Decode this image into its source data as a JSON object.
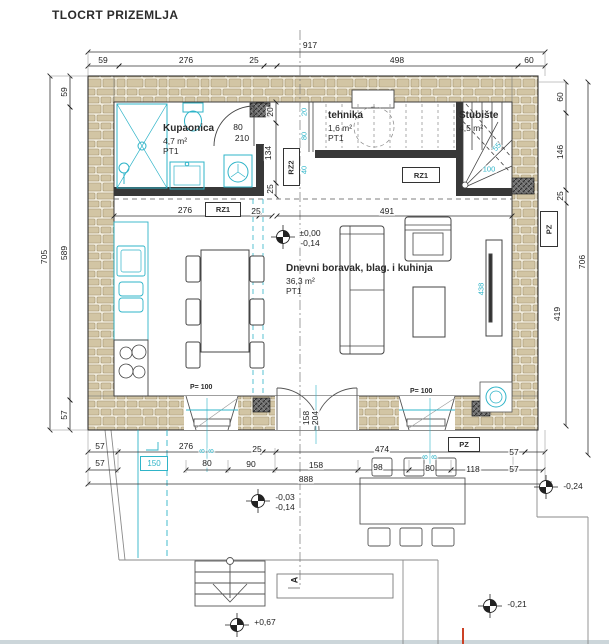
{
  "title": "TLOCRT PRIZEMLJA",
  "colors": {
    "cyan": "#2fb4c8",
    "line": "#2b2b2b",
    "stone": "#d2c5a4",
    "stone_bg": "#f2edde",
    "orange": "#cc4125"
  },
  "rooms": {
    "bathroom": {
      "name": "Kupaonica",
      "area": "4,7 m²",
      "floor": "PT1"
    },
    "utility": {
      "name": "tehnika",
      "area": "1,6 m²",
      "floor": "PT1"
    },
    "staircase": {
      "name": "Stubište",
      "area": "4,5 m²"
    },
    "living": {
      "name": "Dnevni boravak, blag. i kuhinja",
      "area": "36,3 m²",
      "floor": "PT1"
    }
  },
  "tags": {
    "rz1_a": "RZ1",
    "rz1_b": "RZ1",
    "rz2": "RZ2",
    "pz_right": "PZ",
    "pz_bottom": "PZ",
    "window_left": "P= 100",
    "window_right": "P= 100",
    "channel": "150",
    "section": "A"
  },
  "elevations": [
    {
      "top": "±0,00",
      "bottom": "-0,14",
      "x": 283,
      "y": 237,
      "tx": 298,
      "ty": 233
    },
    {
      "top": "-0,03",
      "bottom": "-0,14",
      "x": 258,
      "y": 501,
      "tx": 273,
      "ty": 497
    },
    {
      "top": "+0,67",
      "bottom": "",
      "x": 237,
      "y": 625,
      "tx": 253,
      "ty": 622
    },
    {
      "top": "-0,24",
      "bottom": "",
      "x": 546,
      "y": 487,
      "tx": 561,
      "ty": 486
    },
    {
      "top": "-0,21",
      "bottom": "",
      "x": 490,
      "y": 606,
      "tx": 505,
      "ty": 604
    }
  ],
  "dim_labels": [
    {
      "t": "917",
      "x": 310,
      "y": 45,
      "r": 0
    },
    {
      "t": "59",
      "x": 103,
      "y": 60,
      "r": 0
    },
    {
      "t": "276",
      "x": 186,
      "y": 60,
      "r": 0
    },
    {
      "t": "25",
      "x": 254,
      "y": 60,
      "r": 0
    },
    {
      "t": "498",
      "x": 397,
      "y": 60,
      "r": 0
    },
    {
      "t": "60",
      "x": 529,
      "y": 60,
      "r": 0
    },
    {
      "t": "705",
      "x": 44,
      "y": 257,
      "r": -90
    },
    {
      "t": "59",
      "x": 64,
      "y": 92,
      "r": -90
    },
    {
      "t": "589",
      "x": 64,
      "y": 253,
      "r": -90
    },
    {
      "t": "57",
      "x": 64,
      "y": 415,
      "r": -90
    },
    {
      "t": "60",
      "x": 560,
      "y": 97,
      "r": -90
    },
    {
      "t": "146",
      "x": 560,
      "y": 152,
      "r": -90
    },
    {
      "t": "25",
      "x": 560,
      "y": 196,
      "r": -90
    },
    {
      "t": "419",
      "x": 557,
      "y": 314,
      "r": -90
    },
    {
      "t": "706",
      "x": 582,
      "y": 262,
      "r": -90
    },
    {
      "t": "276",
      "x": 185,
      "y": 210,
      "r": 0
    },
    {
      "t": "25",
      "x": 256,
      "y": 211,
      "r": 0
    },
    {
      "t": "491",
      "x": 387,
      "y": 211,
      "r": 0
    },
    {
      "t": "20",
      "x": 270,
      "y": 112,
      "r": -90
    },
    {
      "t": "134",
      "x": 268,
      "y": 153,
      "r": -90
    },
    {
      "t": "25",
      "x": 270,
      "y": 189,
      "r": -90
    },
    {
      "t": "20",
      "x": 304,
      "y": 112,
      "r": -90,
      "c": "cyan"
    },
    {
      "t": "80",
      "x": 304,
      "y": 136,
      "r": -90,
      "c": "cyan"
    },
    {
      "t": "40",
      "x": 304,
      "y": 170,
      "r": -90,
      "c": "cyan"
    },
    {
      "t": "100",
      "x": 489,
      "y": 169,
      "r": 0,
      "c": "cyan"
    },
    {
      "t": "55",
      "x": 497,
      "y": 147,
      "r": -50,
      "c": "cyan"
    },
    {
      "t": "438",
      "x": 481,
      "y": 289,
      "r": -90,
      "c": "cyan"
    },
    {
      "t": "8",
      "x": 202,
      "y": 451,
      "r": -90,
      "c": "cyan"
    },
    {
      "t": "8",
      "x": 211,
      "y": 451,
      "r": -90,
      "c": "cyan"
    },
    {
      "t": "8",
      "x": 425,
      "y": 457,
      "r": -90,
      "c": "cyan"
    },
    {
      "t": "8",
      "x": 434,
      "y": 457,
      "r": -90,
      "c": "cyan"
    },
    {
      "t": "80",
      "x": 238,
      "y": 127,
      "r": 0
    },
    {
      "t": "210",
      "x": 242,
      "y": 138,
      "r": 0
    },
    {
      "t": "158",
      "x": 306,
      "y": 418,
      "r": -90
    },
    {
      "t": "204",
      "x": 315,
      "y": 418,
      "r": -90
    },
    {
      "t": "57",
      "x": 100,
      "y": 446,
      "r": 0
    },
    {
      "t": "276",
      "x": 186,
      "y": 446,
      "r": 0
    },
    {
      "t": "25",
      "x": 257,
      "y": 449,
      "r": 0
    },
    {
      "t": "474",
      "x": 382,
      "y": 449,
      "r": 0
    },
    {
      "t": "57",
      "x": 514,
      "y": 452,
      "r": 0
    },
    {
      "t": "57",
      "x": 100,
      "y": 463,
      "r": 0
    },
    {
      "t": "80",
      "x": 207,
      "y": 463,
      "r": 0
    },
    {
      "t": "90",
      "x": 251,
      "y": 464,
      "r": 0
    },
    {
      "t": "158",
      "x": 316,
      "y": 465,
      "r": 0
    },
    {
      "t": "98",
      "x": 378,
      "y": 467,
      "r": 0
    },
    {
      "t": "80",
      "x": 430,
      "y": 468,
      "r": 0
    },
    {
      "t": "118",
      "x": 473,
      "y": 469,
      "r": 0
    },
    {
      "t": "57",
      "x": 514,
      "y": 469,
      "r": 0
    },
    {
      "t": "888",
      "x": 306,
      "y": 479,
      "r": 0
    }
  ]
}
